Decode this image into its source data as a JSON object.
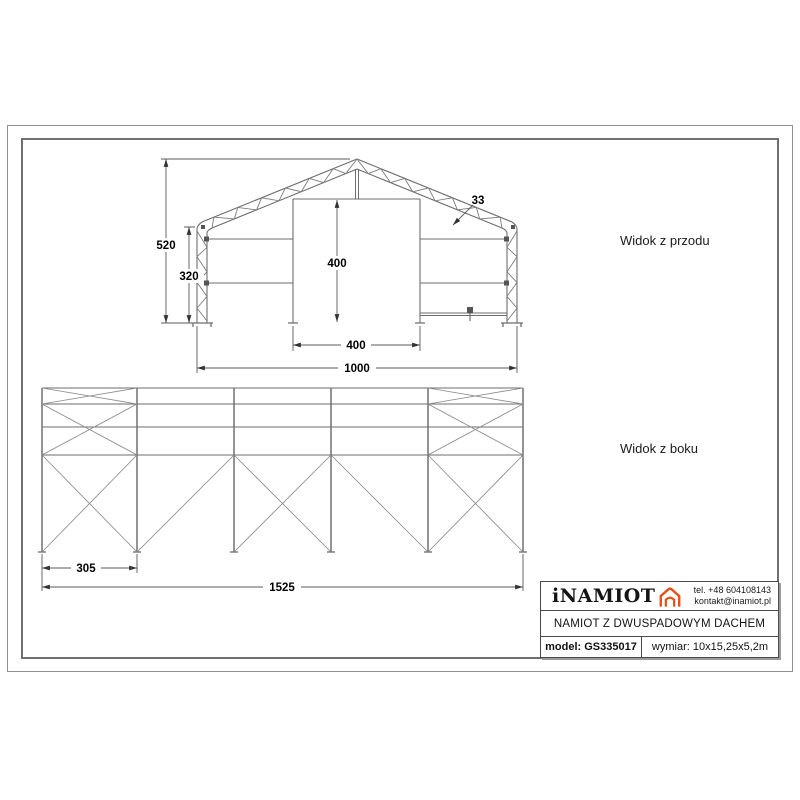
{
  "labels": {
    "front_view": "Widok z przodu",
    "side_view": "Widok z boku"
  },
  "front_view": {
    "total_height": "520",
    "wall_height": "320",
    "door_height": "400",
    "truss_depth": "33",
    "door_width": "400",
    "total_width": "1000"
  },
  "side_view": {
    "bay_width": "305",
    "total_length": "1525"
  },
  "title_block": {
    "brand": "iNAMIOT",
    "phone": "tel. +48 604108143",
    "email": "kontakt@inamiot.pl",
    "product_name": "NAMIOT Z DWUSPADOWYM DACHEM",
    "model": "model: GS335017",
    "dimensions": "wymiar: 10x15,25x5,2m"
  },
  "colors": {
    "accent": "#e8501b",
    "drawing_line": "#6e6e6e"
  }
}
